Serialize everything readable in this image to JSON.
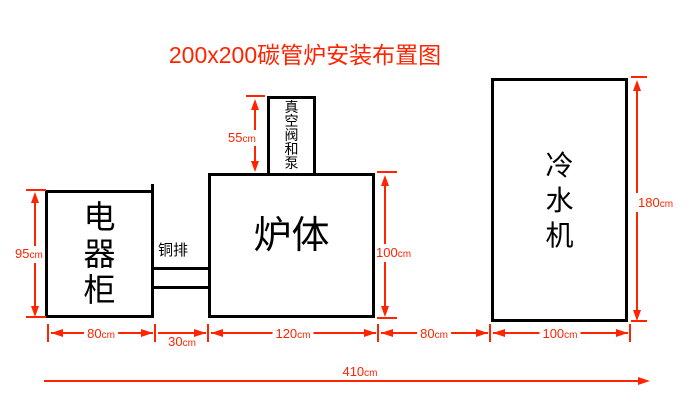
{
  "title": "200x200碳管炉安装布置图",
  "colors": {
    "annotation_red": "#ff2400",
    "box_border": "#000000",
    "background": "#ffffff"
  },
  "boxes": {
    "cabinet": {
      "label": "电器柜"
    },
    "furnace": {
      "label": "炉体"
    },
    "vacuum_pump": {
      "label": "真空阀和泵"
    },
    "chiller": {
      "label": "冷水机"
    },
    "copper_bar": {
      "label": "铜排"
    }
  },
  "dimensions": {
    "cabinet_height": {
      "value": "95",
      "unit": "cm"
    },
    "vacuum_height": {
      "value": "55",
      "unit": "cm"
    },
    "furnace_height": {
      "value": "100",
      "unit": "cm"
    },
    "chiller_height": {
      "value": "180",
      "unit": "cm"
    },
    "cabinet_width": {
      "value": "80",
      "unit": "cm"
    },
    "gap_cabinet_furnace": {
      "value": "30",
      "unit": "cm"
    },
    "furnace_width": {
      "value": "120",
      "unit": "cm"
    },
    "gap_furnace_chiller": {
      "value": "80",
      "unit": "cm"
    },
    "chiller_width": {
      "value": "100",
      "unit": "cm"
    },
    "total_width": {
      "value": "410",
      "unit": "cm"
    }
  }
}
